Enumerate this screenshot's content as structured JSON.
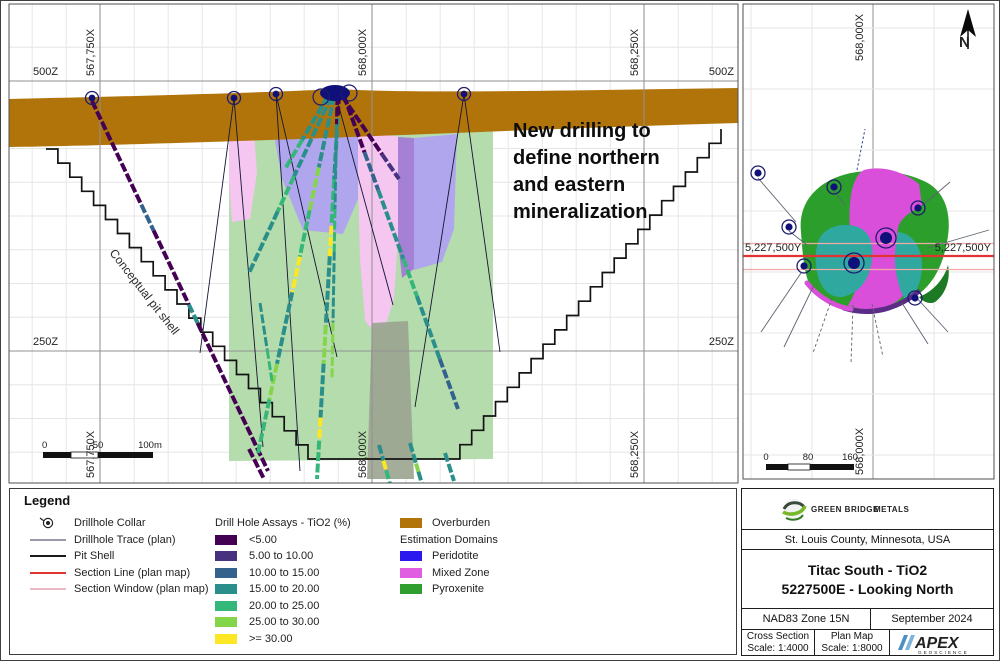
{
  "xsec": {
    "x_top": [
      "567,750X",
      "568,000X",
      "568,250X"
    ],
    "x_bottom": [
      "567,750X",
      "568,000X",
      "568,250X"
    ],
    "z_left": [
      "500Z",
      "250Z"
    ],
    "z_right": [
      "500Z",
      "250Z"
    ],
    "annotation": "New drilling to\ndefine northern\nand eastern\nmineralization",
    "pit_label": "Conceptual pit shell",
    "scalebar_labels": [
      "0",
      "50",
      "100m"
    ]
  },
  "plan": {
    "x_label_top": "568,000X",
    "x_label_bottom": "568,000X",
    "y_label_left": "5,227,500Y",
    "y_label_right": "5,227,500Y",
    "north_label": "N",
    "scalebar_labels": [
      "0",
      "80",
      "160"
    ]
  },
  "legend": {
    "title": "Legend",
    "symbols": [
      {
        "label": "Drillhole Collar",
        "type": "collar",
        "color": "#222222",
        "h": 2
      },
      {
        "label": "Drillhole Trace (plan)",
        "type": "line",
        "color": "#9a9aa8",
        "h": 1.6
      },
      {
        "label": "Pit Shell",
        "type": "line",
        "color": "#1a1a1a",
        "h": 2.4
      },
      {
        "label": "Section Line (plan map)",
        "type": "line",
        "color": "#e23333",
        "h": 2.4
      },
      {
        "label": "Section Window (plan map)",
        "type": "line",
        "color": "#eab9c6",
        "h": 1.8
      }
    ],
    "assay": {
      "header": "Drill Hole Assays - TiO2 (%)",
      "items": [
        {
          "label": "<5.00",
          "color": "#440154"
        },
        {
          "label": "5.00 to 10.00",
          "color": "#46327e"
        },
        {
          "label": "10.00 to 15.00",
          "color": "#33638d"
        },
        {
          "label": "15.00 to 20.00",
          "color": "#2a8f8a"
        },
        {
          "label": "20.00 to 25.00",
          "color": "#35b779"
        },
        {
          "label": "25.00 to 30.00",
          "color": "#85d54a"
        },
        {
          "label": ">= 30.00",
          "color": "#fde725"
        }
      ]
    },
    "domains": {
      "overburden": {
        "label": "Overburden",
        "color": "#b1740a"
      },
      "header": "Estimation Domains",
      "items": [
        {
          "label": "Peridotite",
          "color": "#2a18ef"
        },
        {
          "label": "Mixed Zone",
          "color": "#e05ce0"
        },
        {
          "label": "Pyroxenite",
          "color": "#2f9e2f"
        }
      ]
    }
  },
  "titleblock": {
    "location": "St. Louis County, Minnesota, USA",
    "title_line1": "Titac South - TiO2",
    "title_line2": "5227500E - Looking North",
    "datum": "NAD83 Zone 15N",
    "date": "September 2024",
    "cross_section_label": "Cross Section",
    "cross_section_scale": "Scale: 1:4000",
    "plan_map_label": "Plan Map",
    "plan_map_scale": "Scale: 1:8000",
    "greenbridge_name": "GREEN BRIDGE",
    "greenbridge_suffix": "METALS",
    "apex_name": "APEX",
    "apex_sub": "GEOSCIENCE"
  },
  "figure": {
    "collar_color": "#10107a",
    "grid": {
      "major_x": [
        99,
        371,
        643
      ],
      "major_y": [
        80,
        350
      ]
    },
    "plan_grid": {
      "xs": [
        750,
        811,
        872,
        933
      ],
      "ys": [
        27,
        88,
        149,
        210,
        271,
        332,
        393,
        454
      ],
      "major_x": 872
    },
    "overburden": {
      "name": "overburden",
      "d": "M8,98 C150,95 280,91 335,88 C420,93 580,89 737,87 L737,122 C600,126 450,132 300,138 C180,142 80,145 8,146 Z",
      "fill": "#b1740a"
    },
    "domains": [
      {
        "name": "pyroxenite-window",
        "d": "M228,133 C258,126 305,123 345,126 C405,131 455,127 492,129 L492,458 L228,460 Z",
        "fill": "#b5dcad"
      },
      {
        "name": "mixedzone-window-left",
        "d": "M228,133 L253,131 L256,172 L249,218 L231,221 L228,180 Z",
        "fill": "#f4c6f0"
      },
      {
        "name": "peridotite-window-1",
        "d": "M272,129 L357,131 L357,198 L342,233 L302,229 L281,178 Z",
        "fill": "#b0a6ee"
      },
      {
        "name": "mixedzone-window-center",
        "d": "M357,133 L397,135 L397,238 L393,298 L386,320 C379,331 369,330 364,319 L359,258 L357,180 Z",
        "fill": "#f4c6f0"
      },
      {
        "name": "peridotite-edge",
        "d": "M397,136 L413,137 L413,268 L401,277 L397,240 Z",
        "fill": "#a581d6"
      },
      {
        "name": "peridotite-window-2",
        "d": "M413,137 L456,133 L453,228 L441,261 L413,269 Z",
        "fill": "#b0a6ee"
      },
      {
        "name": "gray-band",
        "d": "M371,322 L407,320 L413,478 L366,478 Z",
        "fill": "#9aa38f",
        "op": 0.9
      }
    ],
    "pit": {
      "left": [
        45,
        148,
        307,
        458,
        22
      ],
      "bottom_x": 447,
      "right": [
        447,
        458,
        720,
        128,
        23
      ],
      "color": "#131313"
    },
    "traces": [
      {
        "x1": 91,
        "y1": 100,
        "x2": 267,
        "y2": 470,
        "w": 4,
        "segs": [
          [
            "#440154",
            0.28
          ],
          [
            "#33638d",
            0.07
          ],
          [
            "#440154",
            0.2
          ],
          [
            "#2a8f8a",
            0.05
          ],
          [
            "#440154",
            0.4
          ]
        ]
      },
      {
        "x1": 330,
        "y1": 96,
        "x2": 248,
        "y2": 272,
        "w": 4,
        "segs": [
          [
            "#2a8f8a",
            0.45
          ],
          [
            "#35b779",
            0.2
          ],
          [
            "#2a8f8a",
            0.35
          ]
        ]
      },
      {
        "x1": 333,
        "y1": 95,
        "x2": 257,
        "y2": 452,
        "w": 4,
        "segs": [
          [
            "#2a8f8a",
            0.2
          ],
          [
            "#85d54a",
            0.12
          ],
          [
            "#35b779",
            0.13
          ],
          [
            "#fde725",
            0.1
          ],
          [
            "#2a8f8a",
            0.2
          ],
          [
            "#85d54a",
            0.1
          ],
          [
            "#35b779",
            0.15
          ]
        ]
      },
      {
        "x1": 338,
        "y1": 94,
        "x2": 316,
        "y2": 478,
        "w": 4,
        "segs": [
          [
            "#440154",
            0.06
          ],
          [
            "#2a8f8a",
            0.16
          ],
          [
            "#35b779",
            0.12
          ],
          [
            "#fde725",
            0.08
          ],
          [
            "#2a8f8a",
            0.18
          ],
          [
            "#85d54a",
            0.1
          ],
          [
            "#2a8f8a",
            0.14
          ],
          [
            "#fde725",
            0.06
          ],
          [
            "#35b779",
            0.1
          ]
        ]
      },
      {
        "x1": 341,
        "y1": 95,
        "x2": 398,
        "y2": 178,
        "w": 4,
        "segs": [
          [
            "#440154",
            0.7
          ],
          [
            "#46327e",
            0.3
          ]
        ]
      },
      {
        "x1": 343,
        "y1": 95,
        "x2": 457,
        "y2": 408,
        "w": 4,
        "segs": [
          [
            "#440154",
            0.18
          ],
          [
            "#33638d",
            0.12
          ],
          [
            "#2a8f8a",
            0.22
          ],
          [
            "#35b779",
            0.12
          ],
          [
            "#2a8f8a",
            0.2
          ],
          [
            "#33638d",
            0.16
          ]
        ]
      },
      {
        "x1": 327,
        "y1": 95,
        "x2": 284,
        "y2": 168,
        "w": 4,
        "segs": [
          [
            "#2a8f8a",
            0.6
          ],
          [
            "#35b779",
            0.4
          ]
        ]
      },
      {
        "x1": 336,
        "y1": 95,
        "x2": 331,
        "y2": 378,
        "w": 3,
        "segs": [
          [
            "#440154",
            0.1
          ],
          [
            "#2a8f8a",
            0.3
          ],
          [
            "#35b779",
            0.15
          ],
          [
            "#2a8f8a",
            0.25
          ],
          [
            "#85d54a",
            0.2
          ]
        ]
      },
      {
        "x1": 378,
        "y1": 444,
        "x2": 389,
        "y2": 483,
        "w": 4,
        "segs": [
          [
            "#2a8f8a",
            0.4
          ],
          [
            "#fde725",
            0.25
          ],
          [
            "#35b779",
            0.35
          ]
        ]
      },
      {
        "x1": 409,
        "y1": 442,
        "x2": 421,
        "y2": 483,
        "w": 4,
        "segs": [
          [
            "#2a8f8a",
            0.5
          ],
          [
            "#85d54a",
            0.2
          ],
          [
            "#2a8f8a",
            0.3
          ]
        ]
      },
      {
        "x1": 444,
        "y1": 452,
        "x2": 453,
        "y2": 480,
        "w": 4,
        "segs": [
          [
            "#2a8f8a",
            1
          ]
        ]
      },
      {
        "x1": 248,
        "y1": 448,
        "x2": 263,
        "y2": 478,
        "w": 4,
        "segs": [
          [
            "#440154",
            1
          ]
        ]
      },
      {
        "x1": 259,
        "y1": 302,
        "x2": 271,
        "y2": 380,
        "w": 3,
        "segs": [
          [
            "#2a8f8a",
            0.6
          ],
          [
            "#35b779",
            0.4
          ]
        ]
      }
    ],
    "black_lines": [
      [
        233,
        97,
        199,
        352
      ],
      [
        233,
        97,
        262,
        446
      ],
      [
        275,
        93,
        299,
        470
      ],
      [
        275,
        93,
        336,
        356
      ],
      [
        463,
        93,
        414,
        406
      ],
      [
        463,
        93,
        499,
        351
      ],
      [
        335,
        95,
        392,
        304
      ]
    ],
    "collars": [
      [
        91,
        97
      ],
      [
        233,
        97
      ],
      [
        275,
        93
      ],
      [
        463,
        93
      ]
    ],
    "cluster": {
      "cx": 334,
      "cy": 92,
      "rx": 15,
      "ry": 8,
      "rings": [
        [
          320,
          96
        ],
        [
          348,
          92
        ]
      ]
    },
    "xsec_scalebar": {
      "x": [
        42,
        70,
        97,
        152
      ],
      "y": 451,
      "h": 6
    },
    "plan_scalebar": {
      "x": [
        765,
        787,
        809,
        853
      ],
      "y": 463,
      "h": 6
    },
    "plan_domains": [
      {
        "name": "plan-pyroxenite",
        "d": "M800,231 C797,204 813,184 839,175 C866,166 901,169 925,181 C946,192 951,216 946,241 C941,269 928,291 904,301 C877,313 844,311 819,297 C804,288 802,259 800,231 Z",
        "fill": "#2b9e2b"
      },
      {
        "name": "plan-mixedzone",
        "d": "M849,204 C850,186 855,173 863,169 C882,164 903,171 918,183 L921,204 C909,212 900,216 897,227 C894,245 899,261 905,276 C909,289 901,299 889,304 C873,310 856,309 847,304 C854,294 857,284 855,270 C851,248 847,224 849,204 Z",
        "fill": "#d94fd9"
      },
      {
        "name": "plan-teal-left",
        "d": "M817,241 C821,228 837,221 854,225 C868,229 873,242 871,258 C869,278 859,292 841,296 C826,297 816,283 815,263 C814,255 815,248 817,241 Z",
        "fill": "#2fa8a0"
      },
      {
        "name": "plan-teal-right",
        "d": "M897,231 C910,232 921,245 921,264 C921,281 915,294 905,300 C898,290 893,269 894,251 C895,243 896,236 897,231 Z",
        "fill": "#2fa8a0"
      },
      {
        "name": "plan-darkgreen",
        "d": "M918,296 C931,291 943,279 947,264 C950,279 944,294 934,301 C928,304 921,300 918,296 Z",
        "fill": "#1d7a24"
      },
      {
        "name": "plan-purple-fringe",
        "d": "M843,307 C868,315 895,309 917,291",
        "fill": "none",
        "stroke": "#5b2c86",
        "w": 5
      },
      {
        "name": "plan-magenta-rim",
        "d": "M806,282 C818,297 835,306 850,308",
        "fill": "none",
        "stroke": "#d94fd9",
        "w": 5
      }
    ],
    "plan_lines": {
      "solid": [
        [
          757,
          177,
          795,
          221
        ],
        [
          788,
          230,
          806,
          244
        ],
        [
          833,
          190,
          844,
          204
        ],
        [
          915,
          210,
          949,
          181
        ],
        [
          926,
          247,
          988,
          229
        ],
        [
          800,
          272,
          760,
          331
        ],
        [
          813,
          284,
          783,
          346
        ],
        [
          901,
          302,
          927,
          343
        ],
        [
          913,
          294,
          947,
          331
        ]
      ],
      "dashed": [
        [
          831,
          297,
          812,
          352
        ],
        [
          852,
          304,
          850,
          363
        ],
        [
          871,
          303,
          882,
          356
        ]
      ],
      "dashed_blue": [
        [
          856,
          169,
          864,
          128
        ]
      ]
    },
    "plan_collars": {
      "normal": [
        [
          757,
          172
        ],
        [
          788,
          226
        ],
        [
          833,
          186
        ],
        [
          917,
          207
        ],
        [
          803,
          265
        ],
        [
          914,
          297
        ]
      ],
      "big": [
        [
          885,
          237
        ],
        [
          853,
          262
        ]
      ]
    },
    "section": {
      "red_y": 255,
      "pink_y": [
        242.5,
        268.5
      ],
      "x0": 742,
      "x1": 993,
      "red": "#e23333",
      "pink": "#f0a8a8"
    }
  }
}
